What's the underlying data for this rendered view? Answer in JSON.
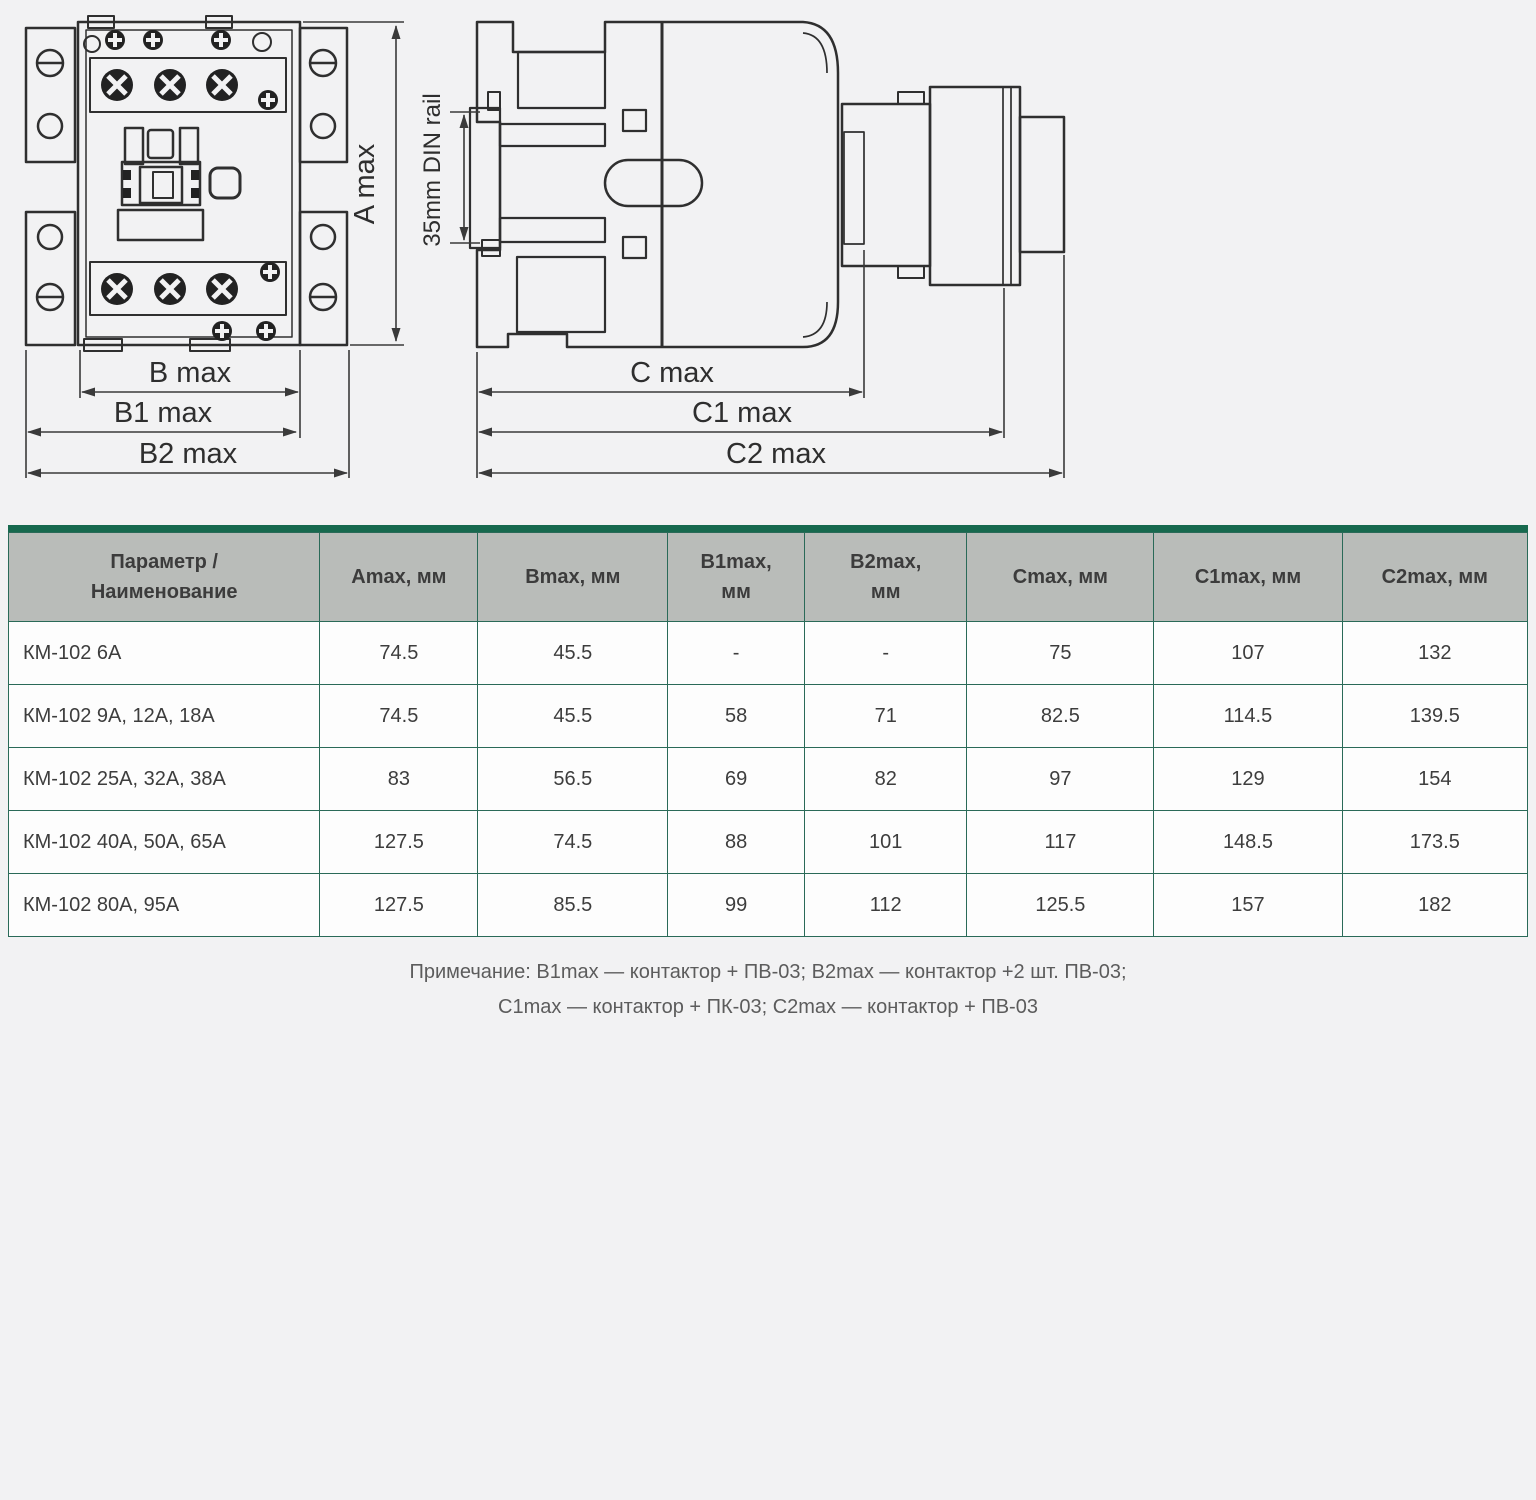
{
  "diagrams": {
    "front_view": {
      "dim_a": "A max",
      "dim_b": "B max",
      "dim_b1": "B1 max",
      "dim_b2": "B2 max"
    },
    "side_view": {
      "din_rail": "35mm DIN rail",
      "dim_c": "C max",
      "dim_c1": "C1 max",
      "dim_c2": "C2 max"
    }
  },
  "table": {
    "headers": [
      "Параметр /\nНаименование",
      "Amax, мм",
      "Bmax, мм",
      "B1max,\nмм",
      "B2max,\nмм",
      "Cmax, мм",
      "C1max, мм",
      "C2max, мм"
    ],
    "rows": [
      {
        "name": "КМ-102 6А",
        "values": [
          "74.5",
          "45.5",
          "-",
          "-",
          "75",
          "107",
          "132"
        ]
      },
      {
        "name": "КМ-102 9А, 12А, 18А",
        "values": [
          "74.5",
          "45.5",
          "58",
          "71",
          "82.5",
          "114.5",
          "139.5"
        ]
      },
      {
        "name": "КМ-102 25А, 32А, 38А",
        "values": [
          "83",
          "56.5",
          "69",
          "82",
          "97",
          "129",
          "154"
        ]
      },
      {
        "name": "КМ-102 40А, 50А, 65А",
        "values": [
          "127.5",
          "74.5",
          "88",
          "101",
          "117",
          "148.5",
          "173.5"
        ]
      },
      {
        "name": "КМ-102 80А, 95А",
        "values": [
          "127.5",
          "85.5",
          "99",
          "112",
          "125.5",
          "157",
          "182"
        ]
      }
    ]
  },
  "note": {
    "line1": "Примечание: B1max — контактор + ПВ-03; B2max — контактор +2 шт. ПВ-03;",
    "line2": "C1max — контактор + ПК-03; C2max — контактор + ПВ-03"
  },
  "colors": {
    "accent_green": "#17694e",
    "table_border": "#2a6a58",
    "header_bg": "#b9bcb9",
    "page_bg": "#f2f2f3",
    "line_art": "#2e2e2e"
  }
}
